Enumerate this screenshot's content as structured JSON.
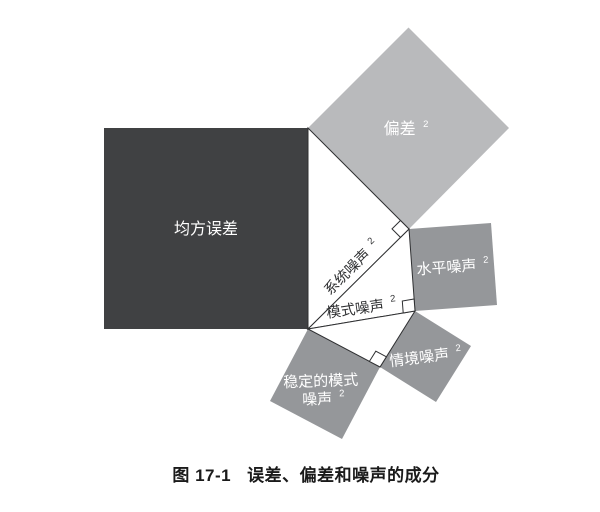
{
  "colors": {
    "background": "#ffffff",
    "mse_fill": "#404143",
    "bias_fill": "#b9babc",
    "noise_fill": "#95979a",
    "triangle_fill": "#ffffff",
    "outline": "#2f3032",
    "shape_label": "#ffffff",
    "edge_label": "#2f3032",
    "caption": "#1a1a1a"
  },
  "labels": {
    "mse": "均方误差",
    "bias": "偏差",
    "system_noise": "系统噪声",
    "level_noise": "水平噪声",
    "pattern_noise": "模式噪声",
    "occasion_noise": "情境噪声",
    "stable_pattern_line1": "稳定的模式",
    "stable_pattern_line2": "噪声",
    "superscript": "2"
  },
  "caption": {
    "figure_number": "图 17-1",
    "title": "误差、偏差和噪声的成分"
  }
}
